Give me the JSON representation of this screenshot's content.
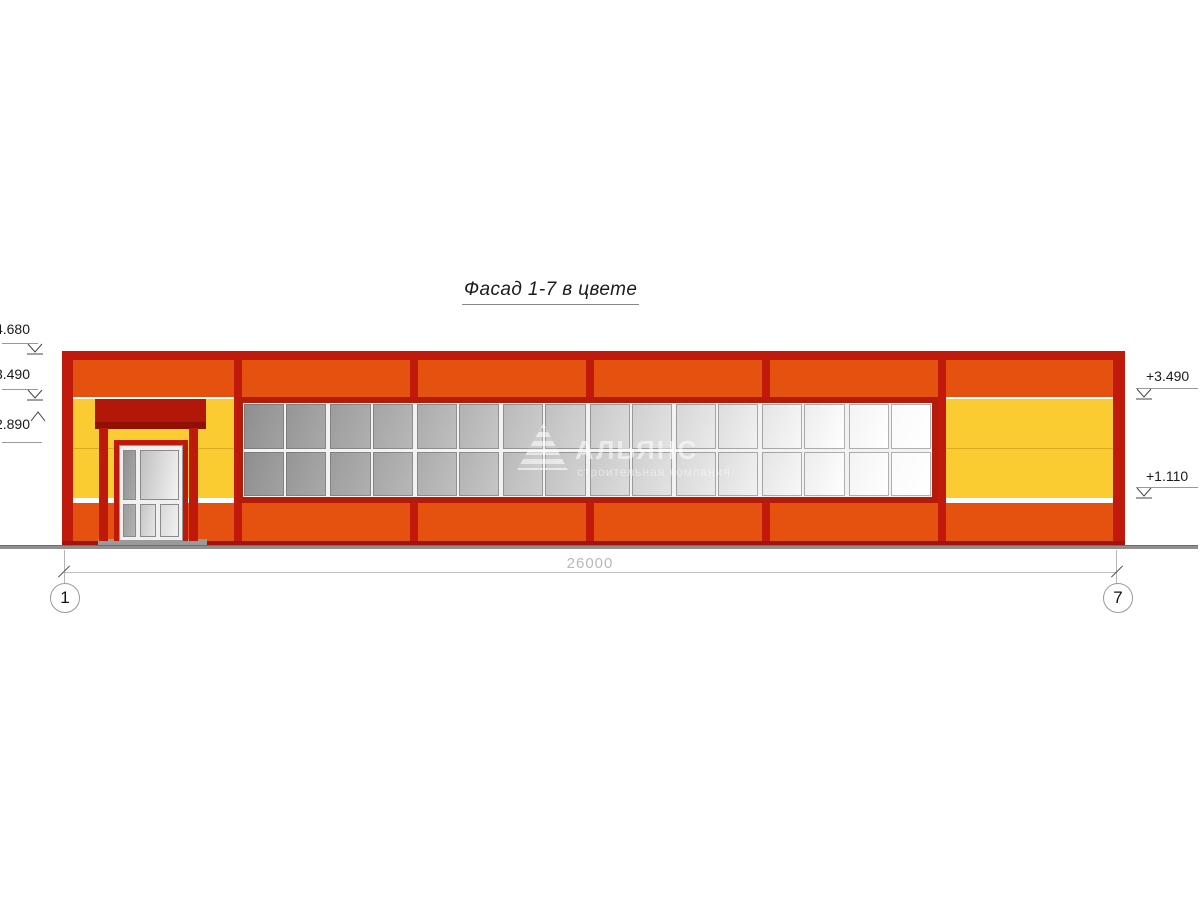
{
  "title": {
    "text": "Фасад 1-7 в цвете"
  },
  "drawing": {
    "elevation_markers_left": [
      {
        "label": "+4.680",
        "direction": "down"
      },
      {
        "label": "+3.490",
        "direction": "down"
      },
      {
        "label": "+2.890",
        "direction": "up"
      }
    ],
    "elevation_markers_right": [
      {
        "label": "+3.490",
        "direction": "down"
      },
      {
        "label": "+1.110",
        "direction": "down"
      }
    ],
    "dimension": {
      "length_label": "26000",
      "axis_start": "1",
      "axis_end": "7"
    },
    "watermark": {
      "name": "АЛЬЯНС",
      "tagline": "строительная компания"
    },
    "window_grid": {
      "rows": 2,
      "cols": 16,
      "shade_from": "#8E8E8E",
      "shade_to": "#FAFAFA"
    },
    "colors": {
      "orange": "#E5520F",
      "yellow": "#FBCB32",
      "red": "#C01A0C",
      "frame-red": "#B51B0B",
      "ground-gray": "#8A8A8A"
    }
  }
}
